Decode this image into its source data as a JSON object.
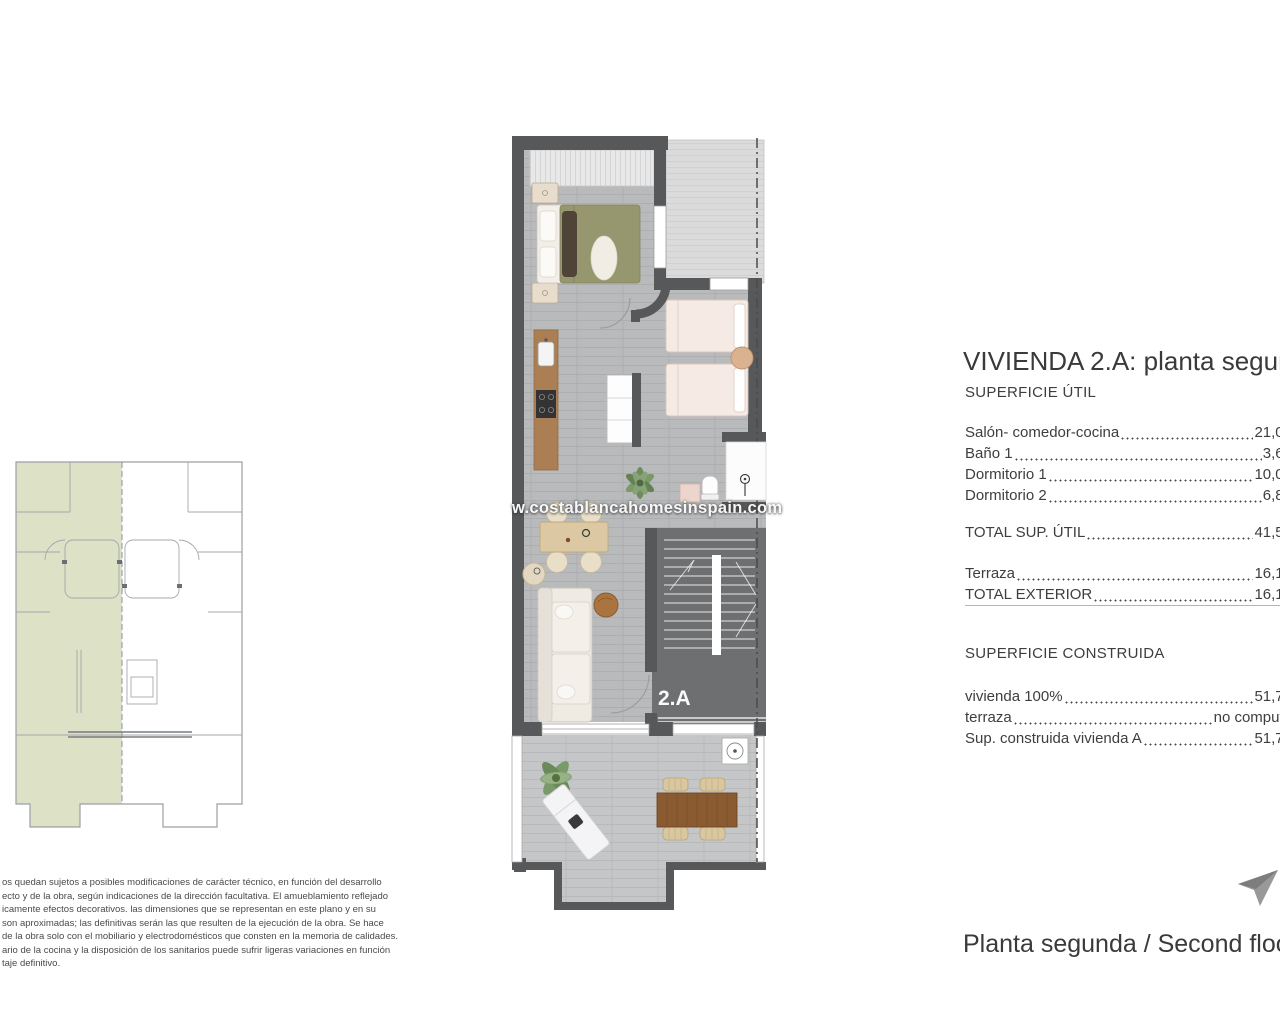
{
  "watermark": "w.costablancahomesinspain.com",
  "plan": {
    "unit_label": "2.A"
  },
  "details": {
    "title": "VIVIENDA 2.A: planta segunda",
    "util_heading": "SUPERFICIE ÚTIL",
    "util_rows": [
      {
        "label": "Salón- comedor-cocina",
        "value": "21,06"
      },
      {
        "label": "Baño 1",
        "value": "3,61"
      },
      {
        "label": "Dormitorio 1",
        "value": "10,01"
      },
      {
        "label": "Dormitorio 2",
        "value": "6,84"
      }
    ],
    "util_total": {
      "label": "TOTAL SUP. ÚTIL",
      "value": "41,52"
    },
    "exterior_rows": [
      {
        "label": "Terraza",
        "value": "16,17"
      },
      {
        "label": "TOTAL EXTERIOR",
        "value": "16,17"
      }
    ],
    "construida_heading": "SUPERFICIE CONSTRUIDA",
    "construida_rows": [
      {
        "label": "vivienda 100%",
        "value": "51,74"
      },
      {
        "label": "terraza",
        "value": "no computa"
      },
      {
        "label": "Sup. construida vivienda A",
        "value": "51,74"
      }
    ]
  },
  "caption": "Planta segunda / Second floor",
  "disclaimer": [
    "os quedan sujetos a posibles modificaciones de carácter técnico, en función del desarrollo",
    "ecto y de la obra, según indicaciones de la dirección facultativa. El amueblamiento reflejado",
    "icamente efectos decorativos. las dimensiones que se representan en este plano y en su",
    "son aproximadas; las definitivas serán las que resulten de la ejecución de la obra. Se hace",
    "de la obra solo con el mobiliario y electrodomésticos que consten en la memoria de calidades.",
    "ario de la cocina y la disposición de los sanitarios puede sufrir ligeras variaciones en función",
    "taje definitivo."
  ]
}
